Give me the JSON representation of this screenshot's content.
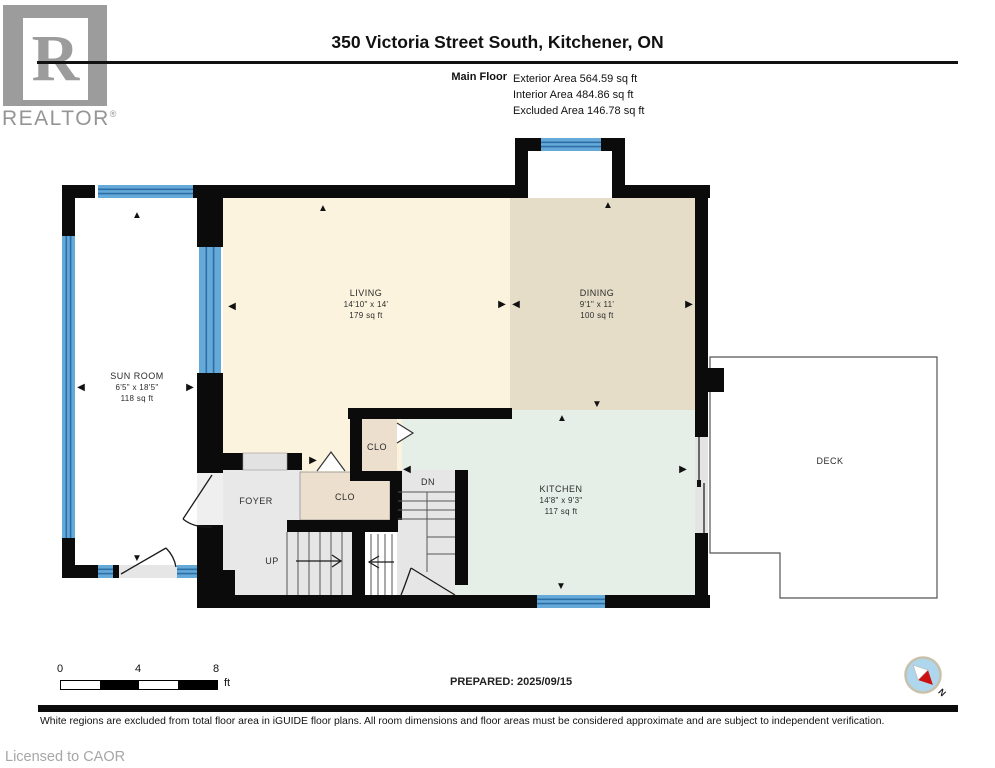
{
  "header": {
    "logo_letter": "R",
    "logo_brand": "REALTOR",
    "logo_reg": "®",
    "title": "350 Victoria Street South, Kitchener, ON",
    "floor_label": "Main Floor",
    "areas": [
      "Exterior Area 564.59 sq ft",
      "Interior Area 484.86 sq ft",
      "Excluded Area 146.78 sq ft"
    ]
  },
  "rooms": {
    "sunroom": {
      "name": "SUN ROOM",
      "dims": "6'5\" x 18'5\"",
      "area": "118 sq ft"
    },
    "living": {
      "name": "LIVING",
      "dims": "14'10\" x 14'",
      "area": "179 sq ft"
    },
    "dining": {
      "name": "DINING",
      "dims": "9'1\" x 11'",
      "area": "100 sq ft"
    },
    "kitchen": {
      "name": "KITCHEN",
      "dims": "14'8\" x 9'3\"",
      "area": "117 sq ft"
    },
    "foyer": {
      "name": "FOYER"
    },
    "closet_upper": {
      "name": "CLO"
    },
    "closet_lower": {
      "name": "CLO"
    },
    "deck": {
      "name": "DECK"
    }
  },
  "stairs": {
    "up_label": "UP",
    "down_label": "DN"
  },
  "icons": {
    "arrow_up": "▲",
    "arrow_down": "▼",
    "arrow_left": "◀",
    "arrow_right": "▶"
  },
  "scale_bar": {
    "tick_0": "0",
    "tick_4": "4",
    "tick_8": "8",
    "unit": "ft"
  },
  "prepared_label": "PREPARED: 2025/09/15",
  "compass": {
    "north_label": "N"
  },
  "footer": {
    "disclaimer": "White regions are excluded from total floor area in iGUIDE floor plans. All room dimensions and floor areas must be considered approximate and are subject to independent verification.",
    "license": "Licensed to CAOR"
  },
  "colors": {
    "wall_black": "#0b0b0b",
    "window_blue": "#64a9d8",
    "living_cream": "#fbf3de",
    "dining_tan": "#e6ddc9",
    "kitchen_mint": "#e5efe7",
    "closet_tan": "#ecdfcd",
    "floor_gray": "#e8e8e8"
  }
}
